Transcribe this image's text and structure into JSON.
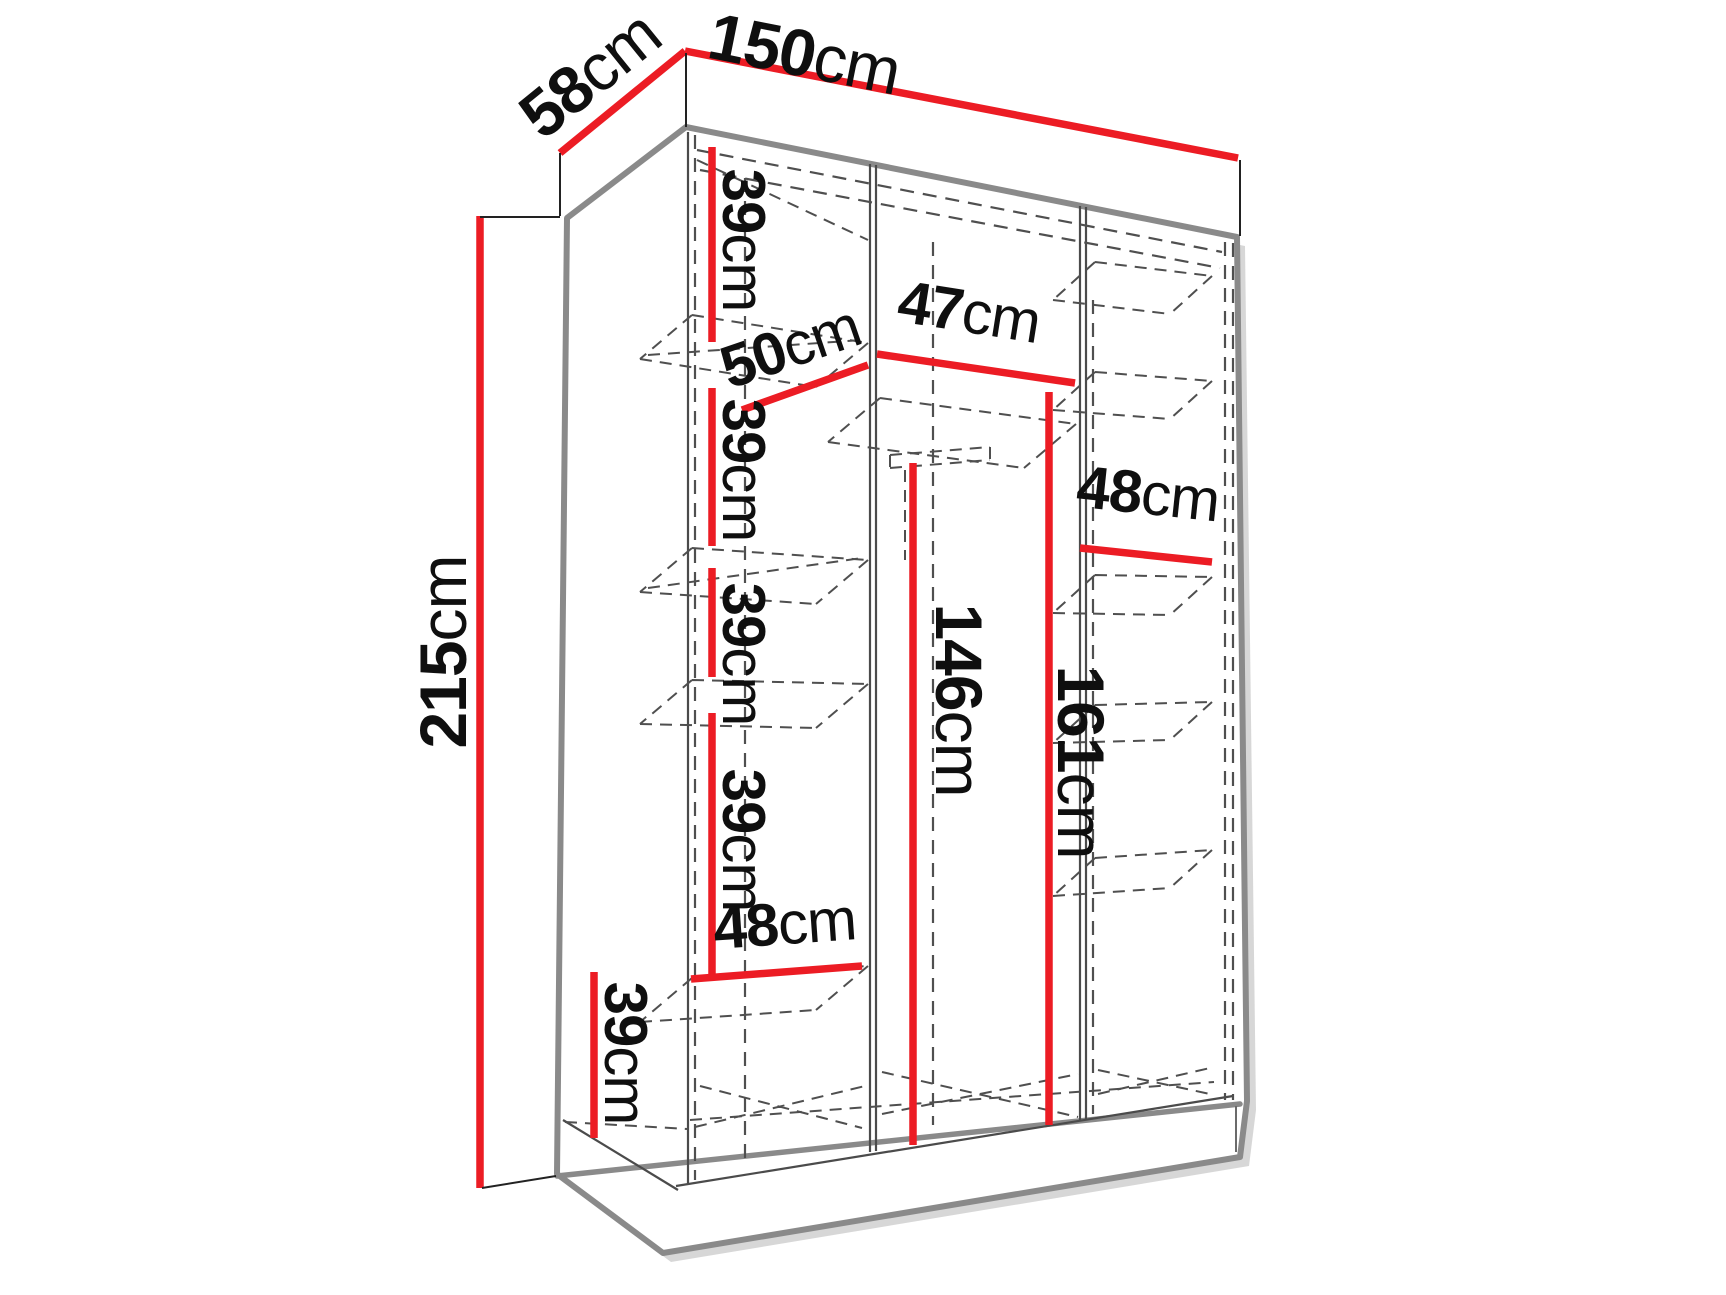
{
  "diagram": {
    "kind": "wardrobe-dimension-drawing",
    "dimensions": [
      {
        "id": "width-top",
        "value": "150",
        "unit": "cm"
      },
      {
        "id": "depth-top",
        "value": "58",
        "unit": "cm"
      },
      {
        "id": "height-left",
        "value": "215",
        "unit": "cm"
      },
      {
        "id": "shelf-gap-1",
        "value": "39",
        "unit": "cm"
      },
      {
        "id": "shelf-depth",
        "value": "50",
        "unit": "cm"
      },
      {
        "id": "middle-width",
        "value": "47",
        "unit": "cm"
      },
      {
        "id": "shelf-gap-2",
        "value": "39",
        "unit": "cm"
      },
      {
        "id": "right-width",
        "value": "48",
        "unit": "cm"
      },
      {
        "id": "shelf-gap-3",
        "value": "39",
        "unit": "cm"
      },
      {
        "id": "hanging-height",
        "value": "146",
        "unit": "cm"
      },
      {
        "id": "section-height",
        "value": "161",
        "unit": "cm"
      },
      {
        "id": "shelf-gap-4",
        "value": "39",
        "unit": "cm"
      },
      {
        "id": "bottom-width",
        "value": "48",
        "unit": "cm"
      },
      {
        "id": "shelf-gap-5",
        "value": "39",
        "unit": "cm"
      }
    ]
  },
  "colors": {
    "dimension-red": "#ec1c24",
    "outline-gray": "#8a8a8a",
    "hidden-gray": "#4f4f4f",
    "text-black": "#0f0f0f",
    "bg": "#ffffff"
  }
}
